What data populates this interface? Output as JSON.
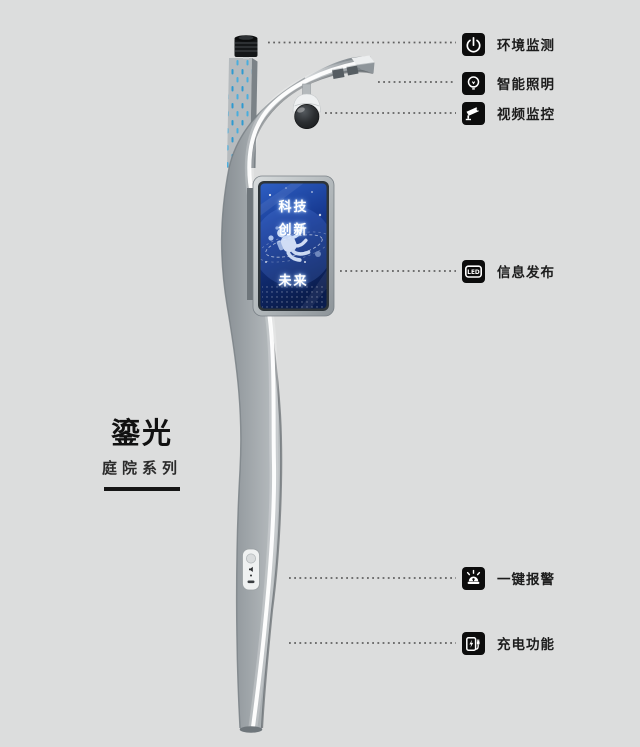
{
  "brand": {
    "name": "鎏光",
    "series": "庭院系列"
  },
  "features": [
    {
      "label": "环境监测"
    },
    {
      "label": "智能照明"
    },
    {
      "label": "视频监控"
    },
    {
      "label": "信息发布",
      "icon_text": "LED"
    },
    {
      "label": "一键报警"
    },
    {
      "label": "充电功能"
    }
  ],
  "screen": {
    "lines": [
      "科技",
      "创新",
      "未来"
    ]
  },
  "colors": {
    "background": "#dcdddd",
    "accent_blue_dots": "#2f9ad0",
    "screen_blue_top": "#2e5fc4",
    "screen_blue_bottom": "#0a1d4e",
    "icon_background": "#0c0c0c",
    "label_text": "#1c1c1c"
  }
}
